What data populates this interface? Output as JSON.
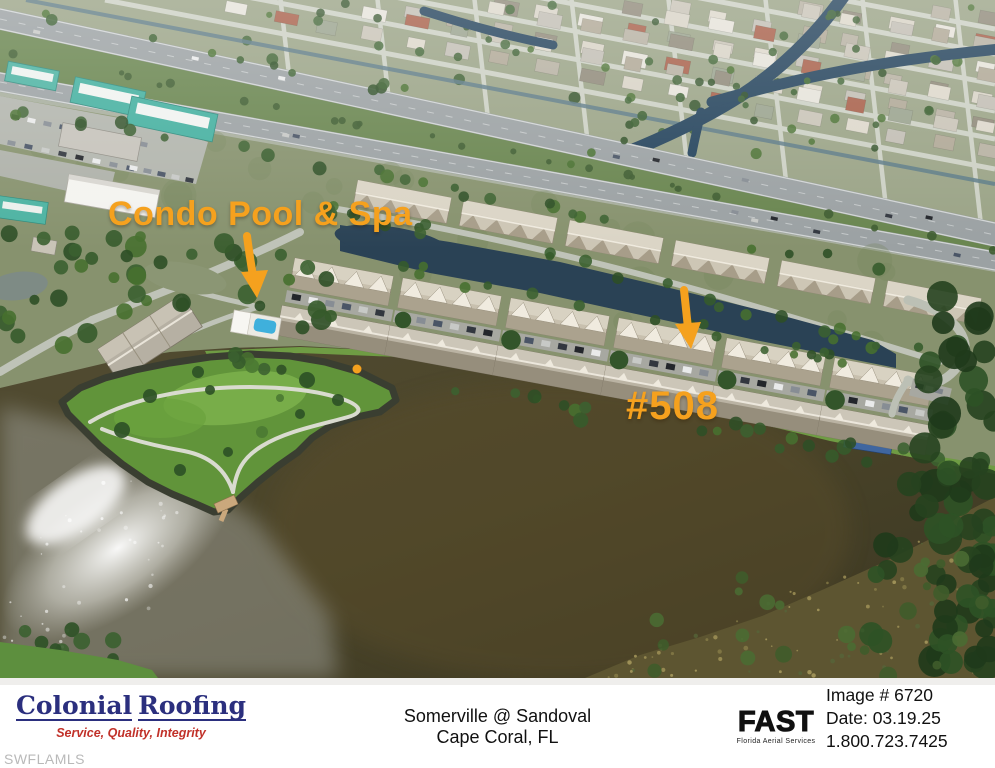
{
  "annotations": {
    "pool_label": "Condo Pool & Spa",
    "unit_label": "#508"
  },
  "footer": {
    "colonial": {
      "name_left": "Colonial",
      "name_right": "Roofing",
      "tagline": "Service, Quality, Integrity"
    },
    "location": {
      "line1": "Somerville @ Sandoval",
      "line2": "Cape Coral, FL"
    },
    "fast": {
      "logo": "FAST",
      "caption": "Florida Aerial Services"
    },
    "meta": {
      "image_number": "Image # 6720",
      "date": "Date: 03.19.25",
      "phone": "1.800.723.7425"
    }
  },
  "watermark": "SWFLAMLS",
  "colors": {
    "accent": "#F5A11E",
    "logo_navy": "#2b2f7e",
    "logo_red": "#c13129"
  }
}
